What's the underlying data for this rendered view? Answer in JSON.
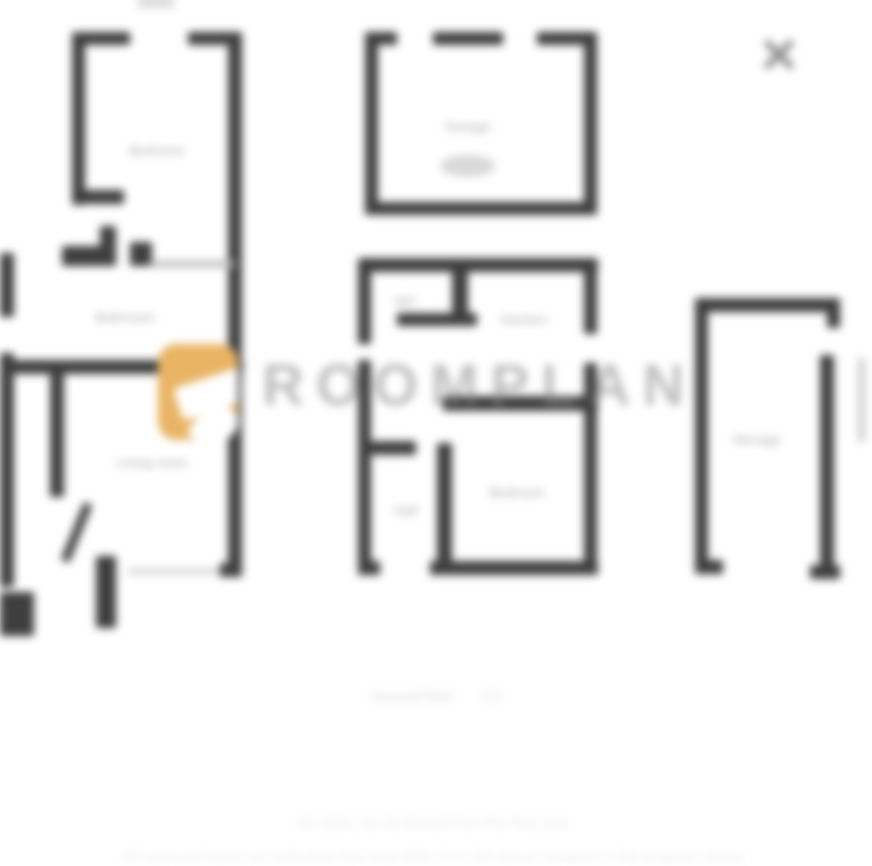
{
  "modal": {
    "close_label": "Close"
  },
  "floorplan": {
    "watermark": {
      "text": "ROOMPLAN",
      "icon": "logo-pin-icon",
      "icon_color": "#E9B464",
      "text_color": "#8A8A8A"
    },
    "rooms": [
      {
        "name": "bedroom-a",
        "label": "Bedroom"
      },
      {
        "name": "bathroom",
        "label": "Bathroom"
      },
      {
        "name": "living-room",
        "label": "Living room"
      },
      {
        "name": "garage",
        "label": "Garage"
      },
      {
        "name": "wc",
        "label": "WC"
      },
      {
        "name": "kitchen",
        "label": "Kitchen"
      },
      {
        "name": "hall",
        "label": "Hall"
      },
      {
        "name": "bedroom-b",
        "label": "Bedroom"
      },
      {
        "name": "storage",
        "label": "Storage"
      }
    ],
    "caption": {
      "label": "Ground floor",
      "meta": "1/2"
    }
  },
  "footer": {
    "line1": "No rights can be derived from this floor plan.",
    "line2": "All measurements are indicative and may differ from the actual situation in the property shown."
  },
  "colors": {
    "wall": "#3E3E3E",
    "room_label": "#A8A8A8",
    "close_icon": "#8F8F8F",
    "accent_orange": "#E9B464"
  }
}
